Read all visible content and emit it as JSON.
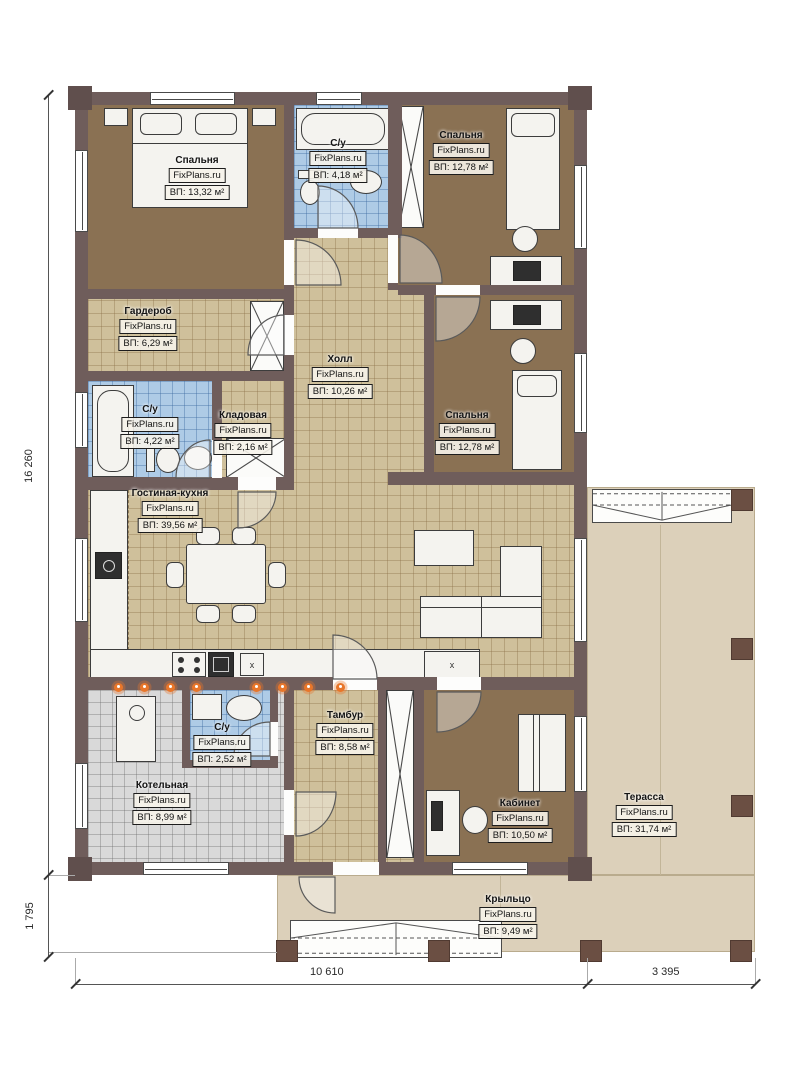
{
  "watermark": "FixPlans.ru",
  "rooms": {
    "bedroom_tl": {
      "name": "Спальня",
      "area": "ВП: 13,32 м²"
    },
    "bathroom_top": {
      "name": "С/у",
      "area": "ВП: 4,18 м²"
    },
    "bedroom_tr": {
      "name": "Спальня",
      "area": "ВП: 12,78 м²"
    },
    "wardrobe": {
      "name": "Гардероб",
      "area": "ВП: 6,29 м²"
    },
    "hall": {
      "name": "Холл",
      "area": "ВП: 10,26 м²"
    },
    "bedroom_mr": {
      "name": "Спальня",
      "area": "ВП: 12,78 м²"
    },
    "bathroom_mid": {
      "name": "С/у",
      "area": "ВП: 4,22 м²"
    },
    "storage": {
      "name": "Кладовая",
      "area": "ВП: 2,16 м²"
    },
    "living_kitchen": {
      "name": "Гостиная-кухня",
      "area": "ВП: 39,56 м²"
    },
    "boiler": {
      "name": "Котельная",
      "area": "ВП: 8,99 м²"
    },
    "bathroom_bottom": {
      "name": "С/у",
      "area": "ВП: 2,52 м²"
    },
    "tambour": {
      "name": "Тамбур",
      "area": "ВП: 8,58 м²"
    },
    "office": {
      "name": "Кабинет",
      "area": "ВП: 10,50 м²"
    },
    "terrace": {
      "name": "Терасса",
      "area": "ВП: 31,74 м²"
    },
    "porch": {
      "name": "Крыльцо",
      "area": "ВП: 9,49 м²"
    }
  },
  "dimensions": {
    "left_height": "16 260",
    "left_porch_height": "1 795",
    "bottom_width": "10 610",
    "bottom_terrace_width": "3 395"
  },
  "colors": {
    "wall": "#6f5d5b",
    "bedroom_floor": "#8a7153",
    "tile_floor": "#cfc09b",
    "bathroom_tile": "#aecbe6",
    "boiler_tile": "#d9d9d9",
    "terrace_floor": "#dcd0ba",
    "flame_accent": "#e8762a"
  },
  "misc": {
    "kitchen_unit_mark": "x"
  }
}
